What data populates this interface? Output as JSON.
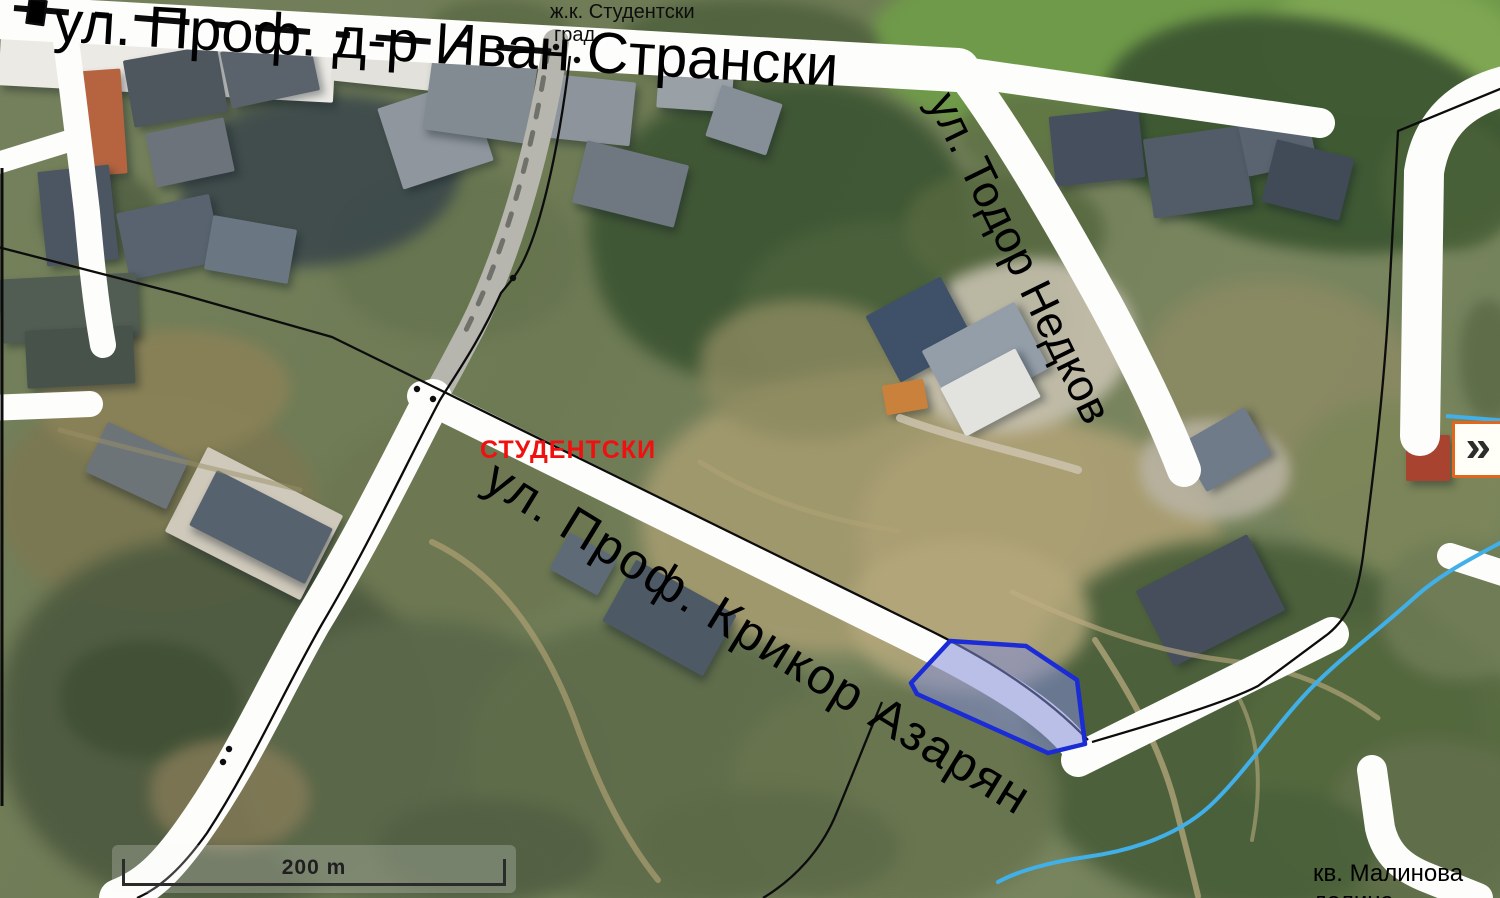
{
  "map": {
    "streets": {
      "ivan_stranski": "ул. Проф. д-р Иван Странски",
      "todor_nedkov": "ул. Тодор Недков",
      "krikor_azaryan": "ул. Проф. Крикор Азарян"
    },
    "labels": {
      "district_red": "СТУДЕНТСКИ",
      "complex_top_line1": "ж.к. Студентски",
      "complex_top_line2": "град",
      "quarter_bottom_line1": "кв. Малинова",
      "quarter_bottom_line2": "долина"
    },
    "scale": {
      "label": "200 m"
    },
    "colors": {
      "parcel_fill": "rgba(130,140,215,0.55)",
      "parcel_stroke": "#1b2bd6",
      "district_label_red": "#f01010",
      "stream_blue": "#41b0e8",
      "expand_button_border": "#e0671c",
      "road_white": "#fdfdfb",
      "boundary_black": "#0c0c0c"
    }
  },
  "controls": {
    "expand_glyph": "»"
  }
}
